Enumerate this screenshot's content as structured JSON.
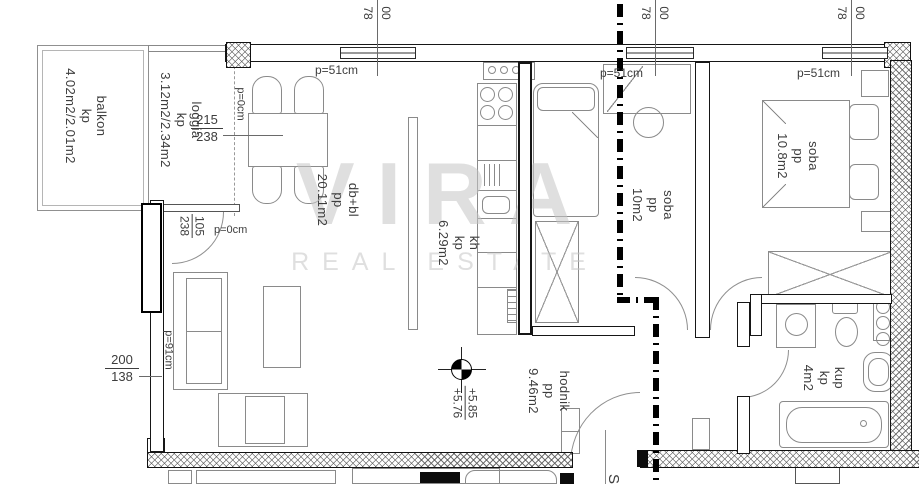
{
  "watermark": {
    "brand": "VIRA",
    "subtitle": "REAL ESTATE"
  },
  "rooms": {
    "balkon": {
      "lines": [
        "balkon",
        "kp",
        "4.02m2/2.01m2"
      ]
    },
    "loggia": {
      "lines": [
        "loggia",
        "kp",
        "3.12m2/2.34m2"
      ]
    },
    "living_dining": {
      "lines": [
        "db+bl",
        "pp",
        "20.11m2"
      ]
    },
    "kitchen": {
      "lines": [
        "kh",
        "kp",
        "6.29m2"
      ]
    },
    "bedroom_small": {
      "lines": [
        "soba",
        "pp",
        "10m2"
      ]
    },
    "bedroom_large": {
      "lines": [
        "soba",
        "pp",
        "10.8m2"
      ]
    },
    "bathroom": {
      "lines": [
        "kup",
        "kp",
        "4m2"
      ]
    },
    "hallway": {
      "lines": [
        "hodnik",
        "pp",
        "9.46m2"
      ]
    }
  },
  "dims": {
    "window_top": {
      "num": "00",
      "den": "78"
    },
    "parapet_51": "p=51cm",
    "parapet_0": "p=0cm",
    "parapet_91": "p=91cm",
    "loggia_window": {
      "num": "215",
      "den": "238"
    },
    "loggia_door": {
      "num": "105",
      "den": "238"
    },
    "left_window": {
      "num": "200",
      "den": "138"
    },
    "level_marker": {
      "upper": "+5.85",
      "lower": "+5.76"
    },
    "stair_label": "S"
  }
}
